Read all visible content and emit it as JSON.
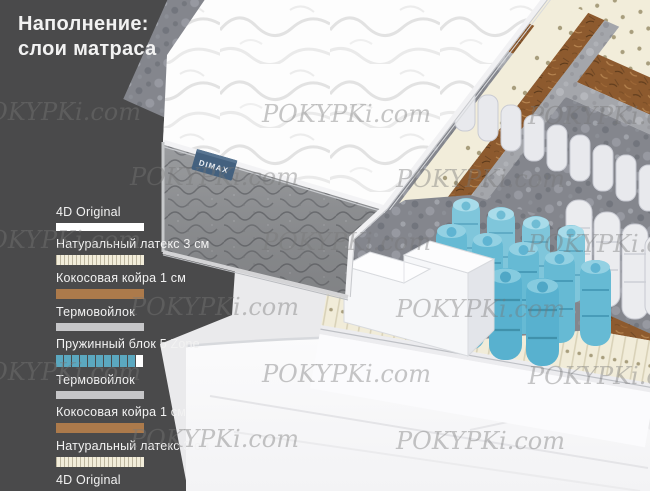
{
  "title": {
    "line1": "Наполнение:",
    "line2": "слои матраса"
  },
  "layers": [
    {
      "label": "4D Original",
      "type": "cover"
    },
    {
      "label": "Натуральный латекс 3 см",
      "type": "latex"
    },
    {
      "label": "Кокосовая койра 1 см",
      "type": "coir"
    },
    {
      "label": "Термовойлок",
      "type": "felt"
    },
    {
      "label": "Пружинный блок 5 Zone",
      "type": "springs"
    },
    {
      "label": "Термовойлок",
      "type": "felt"
    },
    {
      "label": "Кокосовая койра 1 см",
      "type": "coir"
    },
    {
      "label": "Натуральный латекс 3 см",
      "type": "latex"
    },
    {
      "label": "4D Original",
      "type": "cover"
    }
  ],
  "spring_swatch": {
    "blue_count": 10,
    "white_count": 1
  },
  "brand_tag": {
    "label": "DIMAX"
  },
  "watermark": {
    "text": "POKYPKi.com",
    "positions": [
      {
        "x": -28,
        "y": 98
      },
      {
        "x": 262,
        "y": 100
      },
      {
        "x": 528,
        "y": 102
      },
      {
        "x": 130,
        "y": 163
      },
      {
        "x": 396,
        "y": 165
      },
      {
        "x": -28,
        "y": 226
      },
      {
        "x": 262,
        "y": 228
      },
      {
        "x": 528,
        "y": 230
      },
      {
        "x": 130,
        "y": 293
      },
      {
        "x": 396,
        "y": 295
      },
      {
        "x": -28,
        "y": 358
      },
      {
        "x": 262,
        "y": 360
      },
      {
        "x": 528,
        "y": 362
      },
      {
        "x": 130,
        "y": 425
      },
      {
        "x": 396,
        "y": 427
      }
    ]
  },
  "colors": {
    "panel_dark": "#4A4A4B",
    "spring_blue": "#5FB4D2",
    "swatch_blue": "#5BA8C0",
    "coir_brown": "#8D5A2E",
    "latex_cream": "#F2EDDA",
    "felt_gray": "#A4A6AB",
    "tag_navy": "#44617F"
  }
}
